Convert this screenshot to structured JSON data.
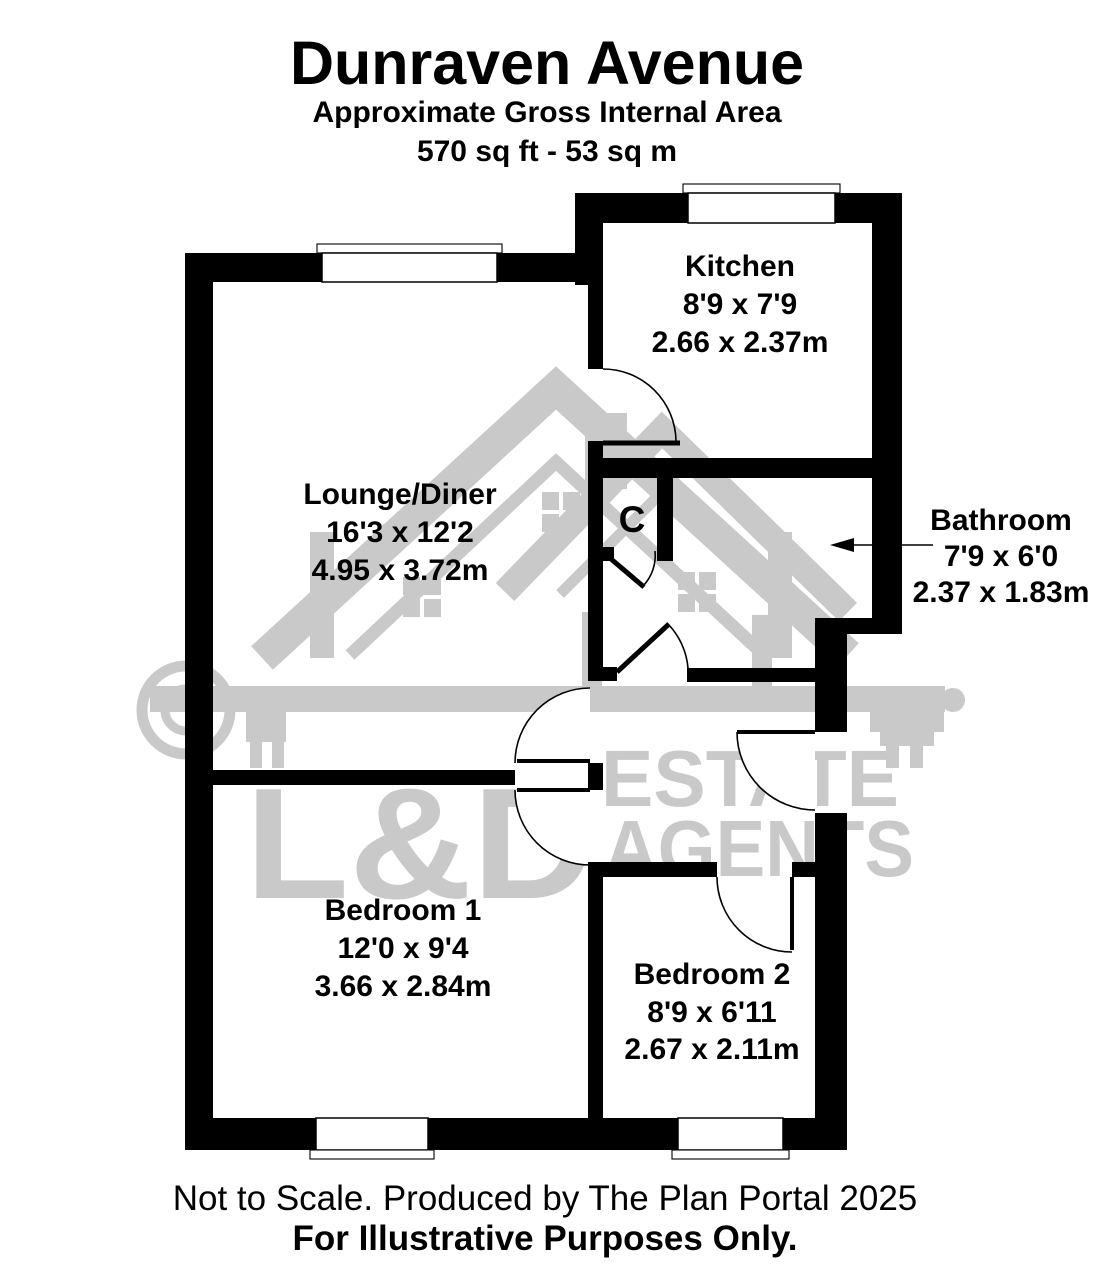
{
  "header": {
    "title": "Dunraven Avenue",
    "subtitle": "Approximate Gross Internal Area",
    "area": "570 sq ft - 53 sq m"
  },
  "rooms": {
    "kitchen": {
      "name": "Kitchen",
      "imperial": "8'9 x 7'9",
      "metric": "2.66 x 2.37m"
    },
    "lounge": {
      "name": "Lounge/Diner",
      "imperial": "16'3 x 12'2",
      "metric": "4.95 x 3.72m"
    },
    "bathroom": {
      "name": "Bathroom",
      "imperial": "7'9 x 6'0",
      "metric": "2.37 x 1.83m"
    },
    "bedroom1": {
      "name": "Bedroom 1",
      "imperial": "12'0 x 9'4",
      "metric": "3.66 x 2.84m"
    },
    "bedroom2": {
      "name": "Bedroom 2",
      "imperial": "8'9 x 6'11",
      "metric": "2.67 x 2.11m"
    },
    "cupboard": {
      "label": "C"
    }
  },
  "watermark": {
    "logo": "L&D",
    "line1": "ESTATE",
    "line2": "AGENTS",
    "color": "#c9c9c9"
  },
  "footer": {
    "line1": "Not to Scale. Produced by The Plan Portal 2025",
    "line2": "For Illustrative Purposes Only."
  },
  "colors": {
    "wall": "#000000",
    "background": "#ffffff"
  }
}
